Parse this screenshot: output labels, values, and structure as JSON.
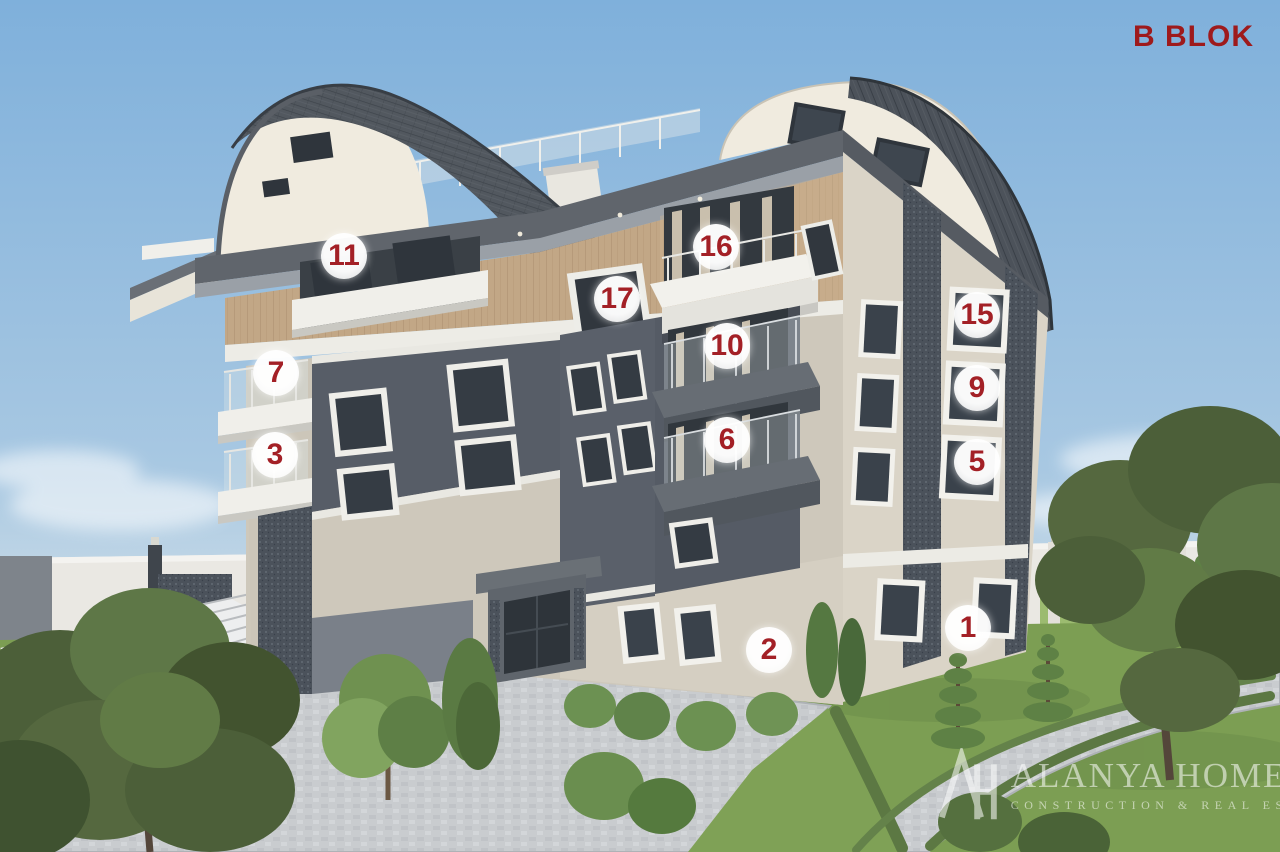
{
  "title": {
    "label": "B BLOK",
    "color": "#9E1A1C"
  },
  "badges": [
    {
      "label": "11"
    },
    {
      "label": "16"
    },
    {
      "label": "17"
    },
    {
      "label": "10"
    },
    {
      "label": "7"
    },
    {
      "label": "6"
    },
    {
      "label": "3"
    },
    {
      "label": "15"
    },
    {
      "label": "9"
    },
    {
      "label": "5"
    },
    {
      "label": "1"
    },
    {
      "label": "2"
    }
  ],
  "badge_style": {
    "background": "#FFFFFF",
    "number_color": "#A32026"
  },
  "watermark": {
    "monogram": "AH",
    "brand": "ALANYA HOME",
    "tagline": "CONSTRUCTION & REAL ESTATE",
    "color": "#FFFFFF"
  },
  "palette": {
    "sky_top": "#7FB0DB",
    "sky_horizon": "#D9E4EA",
    "roof_tiles": "#50565E",
    "roof_arch_face": "#F0EBDF",
    "wood_cladding": "#C2A786",
    "wall_beige_front": "#CEC8BB",
    "wall_beige_right": "#DAD4C7",
    "panel_dark": "#565C66",
    "panel_textured": "#49505A",
    "balcony_white": "#F0EFEA",
    "grass": "#7C9E53",
    "paving": "#C9CCCF",
    "perimeter_wall": "#EAE8E3"
  }
}
